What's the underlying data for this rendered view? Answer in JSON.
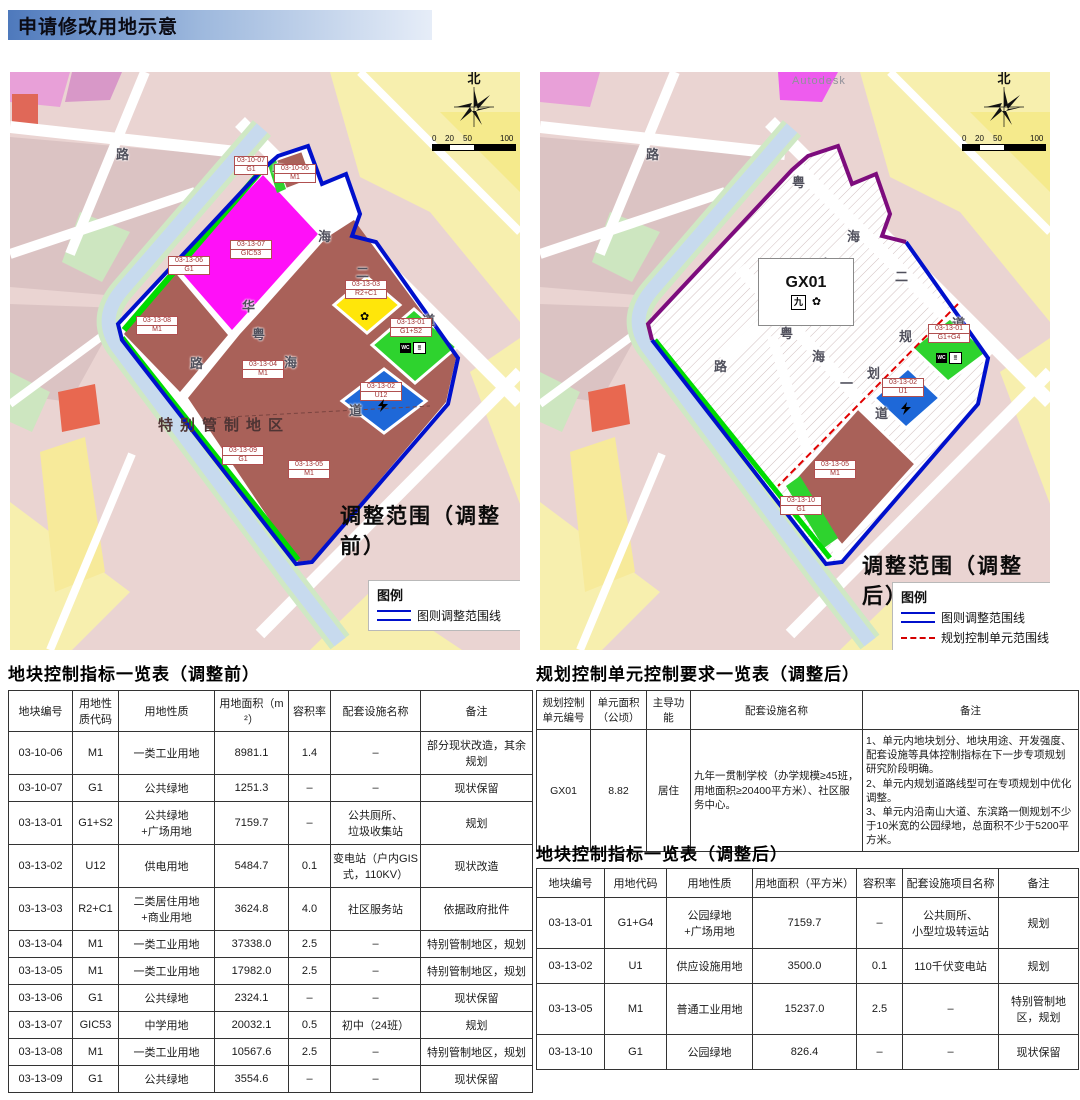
{
  "title": "申请修改用地示意",
  "colors": {
    "boundary_blue": "#0010cc",
    "unit_purple": "#7d0c7d",
    "unit_red_dashed": "#d40000",
    "industrial_brown": "#a96159",
    "school_magenta": "#ff10f8",
    "residential_yellow": "#ffe60a",
    "green_space": "#2ed32e",
    "utility_blue": "#1e68d8"
  },
  "maps": {
    "before": {
      "caption": "调整范围（调整前）",
      "north_label": "北",
      "scale_ticks": [
        "0",
        "20",
        "50",
        "100"
      ],
      "special_label": "特别管制地区",
      "legend": {
        "title": "图例",
        "items": [
          {
            "label": "图则调整范围线"
          }
        ]
      },
      "roads": [
        "粤",
        "海",
        "二",
        "道",
        "华",
        "粤",
        "海",
        "道",
        "路",
        "路"
      ],
      "parcels": [
        {
          "id": "03-10-07",
          "code": "G1"
        },
        {
          "id": "03-10-06",
          "code": "M1"
        },
        {
          "id": "03-13-07",
          "code": "GIC53"
        },
        {
          "id": "03-13-06",
          "code": "G1"
        },
        {
          "id": "03-13-08",
          "code": "M1"
        },
        {
          "id": "03-13-04",
          "code": "M1"
        },
        {
          "id": "03-13-03",
          "code": "R2+C1"
        },
        {
          "id": "03-13-01",
          "code": "G1+S2"
        },
        {
          "id": "03-13-02",
          "code": "U12"
        },
        {
          "id": "03-13-05",
          "code": "M1"
        },
        {
          "id": "03-13-09",
          "code": "G1"
        }
      ]
    },
    "after": {
      "caption": "调整范围（调整后）",
      "watermark": "Autodesk",
      "north_label": "北",
      "scale_ticks": [
        "0",
        "20",
        "50",
        "100"
      ],
      "unit_box": {
        "label": "GX01",
        "school_icon": "九"
      },
      "legend": {
        "title": "图例",
        "items": [
          {
            "label": "图则调整范围线"
          },
          {
            "label": "规划控制单元范围线"
          }
        ]
      },
      "roads": [
        "粤",
        "海",
        "南",
        "二",
        "道",
        "华",
        "粤",
        "海",
        "一",
        "道",
        "规",
        "划",
        "路",
        "路"
      ],
      "parcels": [
        {
          "id": "03-13-01",
          "code": "G1+G4"
        },
        {
          "id": "03-13-02",
          "code": "U1"
        },
        {
          "id": "03-13-05",
          "code": "M1"
        },
        {
          "id": "03-13-10",
          "code": "G1"
        }
      ]
    }
  },
  "tables": {
    "before": {
      "title": "地块控制指标一览表（调整前）",
      "headers": [
        "地块编号",
        "用地性质代码",
        "用地性质",
        "用地面积（m²）",
        "容积率",
        "配套设施名称",
        "备注"
      ],
      "rows": [
        [
          "03-10-06",
          "M1",
          "一类工业用地",
          "8981.1",
          "1.4",
          "–",
          "部分现状改造，其余规划"
        ],
        [
          "03-10-07",
          "G1",
          "公共绿地",
          "1251.3",
          "–",
          "–",
          "现状保留"
        ],
        [
          "03-13-01",
          "G1+S2",
          "公共绿地\n+广场用地",
          "7159.7",
          "–",
          "公共厕所、\n垃圾收集站",
          "规划"
        ],
        [
          "03-13-02",
          "U12",
          "供电用地",
          "5484.7",
          "0.1",
          "变电站（户内GIS式，110KV）",
          "现状改造"
        ],
        [
          "03-13-03",
          "R2+C1",
          "二类居住用地\n+商业用地",
          "3624.8",
          "4.0",
          "社区服务站",
          "依据政府批件"
        ],
        [
          "03-13-04",
          "M1",
          "一类工业用地",
          "37338.0",
          "2.5",
          "–",
          "特别管制地区，规划"
        ],
        [
          "03-13-05",
          "M1",
          "一类工业用地",
          "17982.0",
          "2.5",
          "–",
          "特别管制地区，规划"
        ],
        [
          "03-13-06",
          "G1",
          "公共绿地",
          "2324.1",
          "–",
          "–",
          "现状保留"
        ],
        [
          "03-13-07",
          "GIC53",
          "中学用地",
          "20032.1",
          "0.5",
          "初中（24班）",
          "规划"
        ],
        [
          "03-13-08",
          "M1",
          "一类工业用地",
          "10567.6",
          "2.5",
          "–",
          "特别管制地区，规划"
        ],
        [
          "03-13-09",
          "G1",
          "公共绿地",
          "3554.6",
          "–",
          "–",
          "现状保留"
        ]
      ]
    },
    "unit": {
      "title": "规划控制单元控制要求一览表（调整后）",
      "headers": [
        "规划控制单元编号",
        "单元面积（公顷）",
        "主导功能",
        "配套设施名称",
        "备注"
      ],
      "rows": [
        [
          "GX01",
          "8.82",
          "居住",
          "九年一贯制学校（办学规模≥45班，用地面积≥20400平方米）、社区服务中心。",
          "1、单元内地块划分、地块用途、开发强度、配套设施等具体控制指标在下一步专项规划研究阶段明确。\n2、单元内规划道路线型可在专项规划中优化调整。\n3、单元内沿南山大道、东滨路一侧规划不少于10米宽的公园绿地，总面积不少于5200平方米。"
        ]
      ]
    },
    "after": {
      "title": "地块控制指标一览表（调整后）",
      "headers": [
        "地块编号",
        "用地代码",
        "用地性质",
        "用地面积（平方米）",
        "容积率",
        "配套设施项目名称",
        "备注"
      ],
      "rows": [
        [
          "03-13-01",
          "G1+G4",
          "公园绿地\n+广场用地",
          "7159.7",
          "–",
          "公共厕所、\n小型垃圾转运站",
          "规划"
        ],
        [
          "03-13-02",
          "U1",
          "供应设施用地",
          "3500.0",
          "0.1",
          "110千伏变电站",
          "规划"
        ],
        [
          "03-13-05",
          "M1",
          "普通工业用地",
          "15237.0",
          "2.5",
          "–",
          "特别管制地区，规划"
        ],
        [
          "03-13-10",
          "G1",
          "公园绿地",
          "826.4",
          "–",
          "–",
          "现状保留"
        ]
      ]
    }
  }
}
